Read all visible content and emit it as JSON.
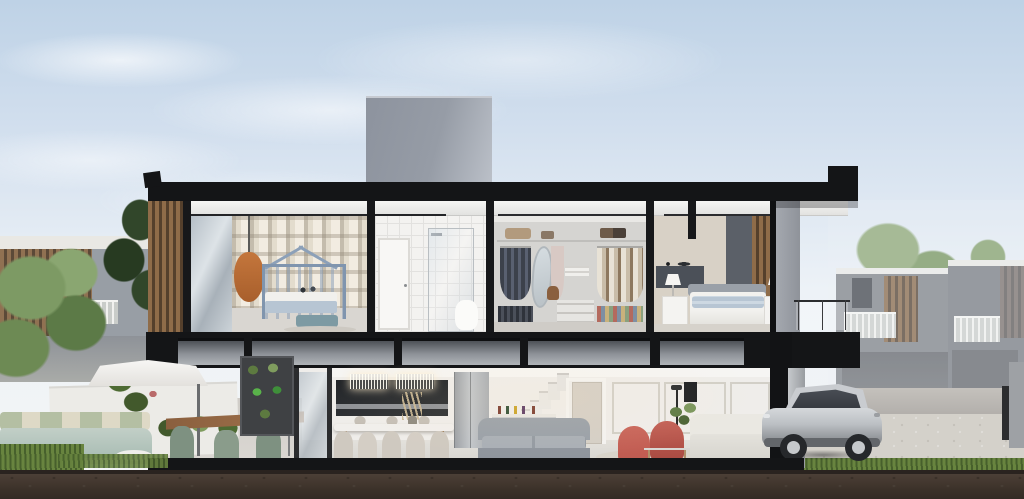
{
  "scene": {
    "type": "architectural-cutaway-render",
    "description": "Cross-section rendering of a modern two-story townhouse, no visible text",
    "upper_floor": [
      "kids-bedroom-plaid-wall-house-bed",
      "hanging-chair",
      "bathroom",
      "walk-in-closet",
      "master-bedroom",
      "balcony"
    ],
    "ground_floor": [
      "garden-patio-with-umbrella",
      "outdoor-lounge",
      "outdoor-dining",
      "dining-room-with-chandeliers",
      "kitchen",
      "fridge",
      "staircase",
      "bar-console",
      "living-room-gray-sofa",
      "red-armchairs",
      "white-sofa"
    ],
    "exterior": [
      "rooftop-volume",
      "black-roof-slab",
      "wood-slat-screen",
      "silver-suv-on-driveway",
      "neighbor-townhouses",
      "trees",
      "soil-cross-section"
    ]
  },
  "palette": {
    "sky_top": "#bed2e6",
    "sky_low": "#edf2f7",
    "slab": "#141517",
    "ceiling": "#f6f6f4",
    "roof_box": "#969ca6",
    "wood": "#8f6c49",
    "wood_dark": "#55402c",
    "tile": "#f3f2f0",
    "closet_bg": "#d5d4d1",
    "master_accent": "#5b6068",
    "bed_blue": "#b7c5d3",
    "chair_orange": "#c4763c",
    "sofa_gray": "#99a0a8",
    "sofa_white": "#eae8e2",
    "armchair_red": "#bf5a50",
    "chair_sage": "#7e9181",
    "kitchen_dark": "#2a2d31",
    "grass": "#68843f",
    "grass_dark": "#47602c",
    "soil": "#473b32",
    "street": "#b0ada9",
    "paver": "#d4d1ca",
    "car_silver": "#bcc0c4",
    "neighbor": "#84888e"
  }
}
